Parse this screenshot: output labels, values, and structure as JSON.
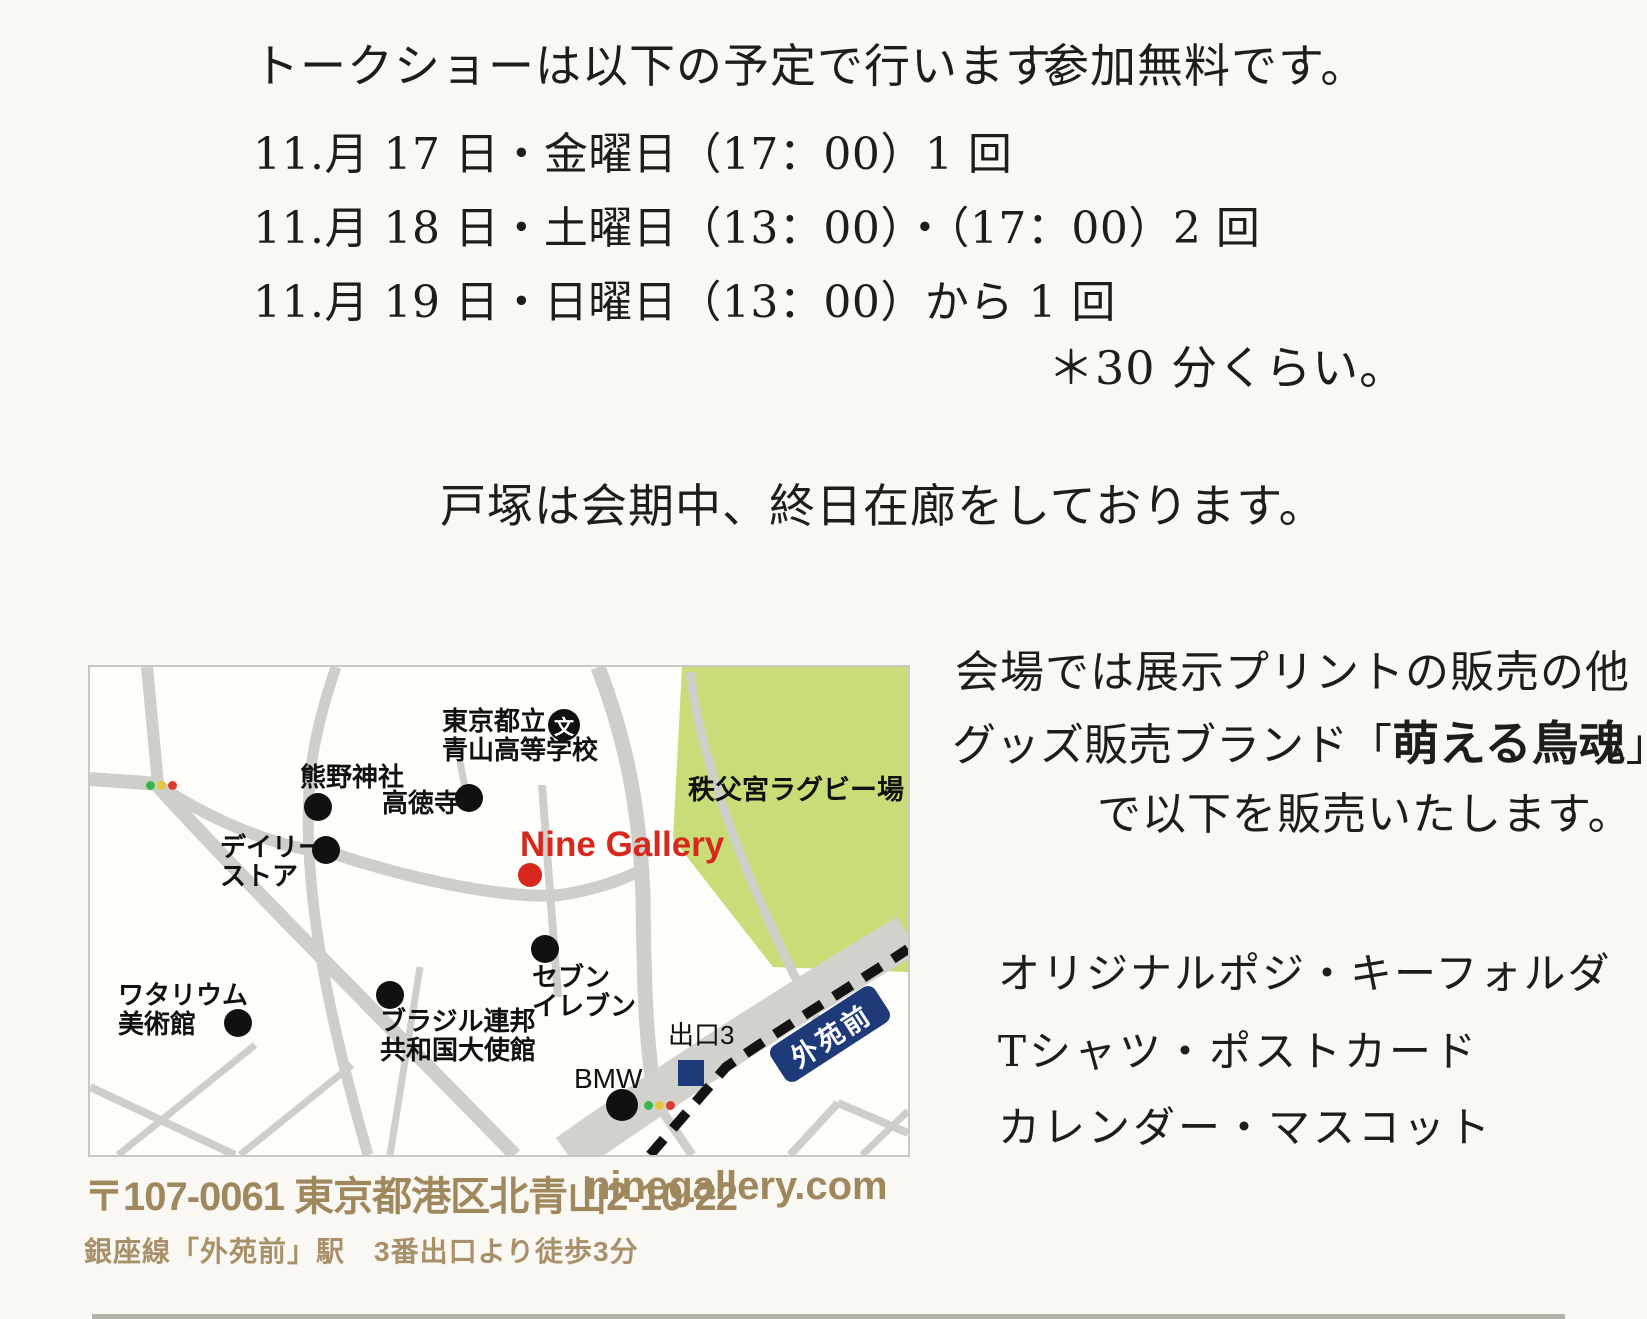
{
  "schedule": {
    "intro": "トークショーは以下の予定で行います。",
    "free_note": "参加無料です。",
    "dates": [
      "11.月 17 日・金曜日（17：00）1 回",
      "11.月 18 日・土曜日（13：00）・（17：00）2 回",
      "11.月 19 日・日曜日（13：00）から 1 回"
    ],
    "duration_note": "＊30 分くらい。",
    "attendance_note": "戸塚は会期中、終日在廊をしております。"
  },
  "sales": {
    "line1": "会場では展示プリントの販売の他",
    "line2_prefix": "グッズ販売ブランド",
    "bracket_open": "「",
    "brand_name": "萌える鳥魂",
    "bracket_close": "」",
    "line3": "で以下を販売いたします。",
    "items": [
      "オリジナルポジ・キーフォルダ",
      "Tシャツ・ポストカード",
      "カレンダー・マスコット"
    ]
  },
  "map": {
    "gallery_name": "Nine Gallery",
    "station_badge": "外苑前",
    "exit_label": "出口3",
    "school_icon_glyph": "文",
    "rugby_field": "秩父宮ラグビー場",
    "pois": [
      {
        "label": "東京都立\n青山高等学校"
      },
      {
        "label": "熊野神社"
      },
      {
        "label": "高徳寺"
      },
      {
        "label": "デイリー\nストア"
      },
      {
        "label": "ワタリウム\n美術館"
      },
      {
        "label": "ブラジル連邦\n共和国大使館"
      },
      {
        "label": "セブン\nイレブン"
      },
      {
        "label": "BMW"
      }
    ]
  },
  "footer": {
    "address": "〒107-0061 東京都港区北青山2-10-22",
    "website": "ninegallery.com",
    "access": "銀座線「外苑前」駅　3番出口より徒歩3分"
  },
  "colors": {
    "accent_red": "#d8281e",
    "navy": "#1e3a78",
    "field_green": "#c8dc78",
    "road_gray": "#cfcfca",
    "footer_tan": "#a0885e"
  }
}
